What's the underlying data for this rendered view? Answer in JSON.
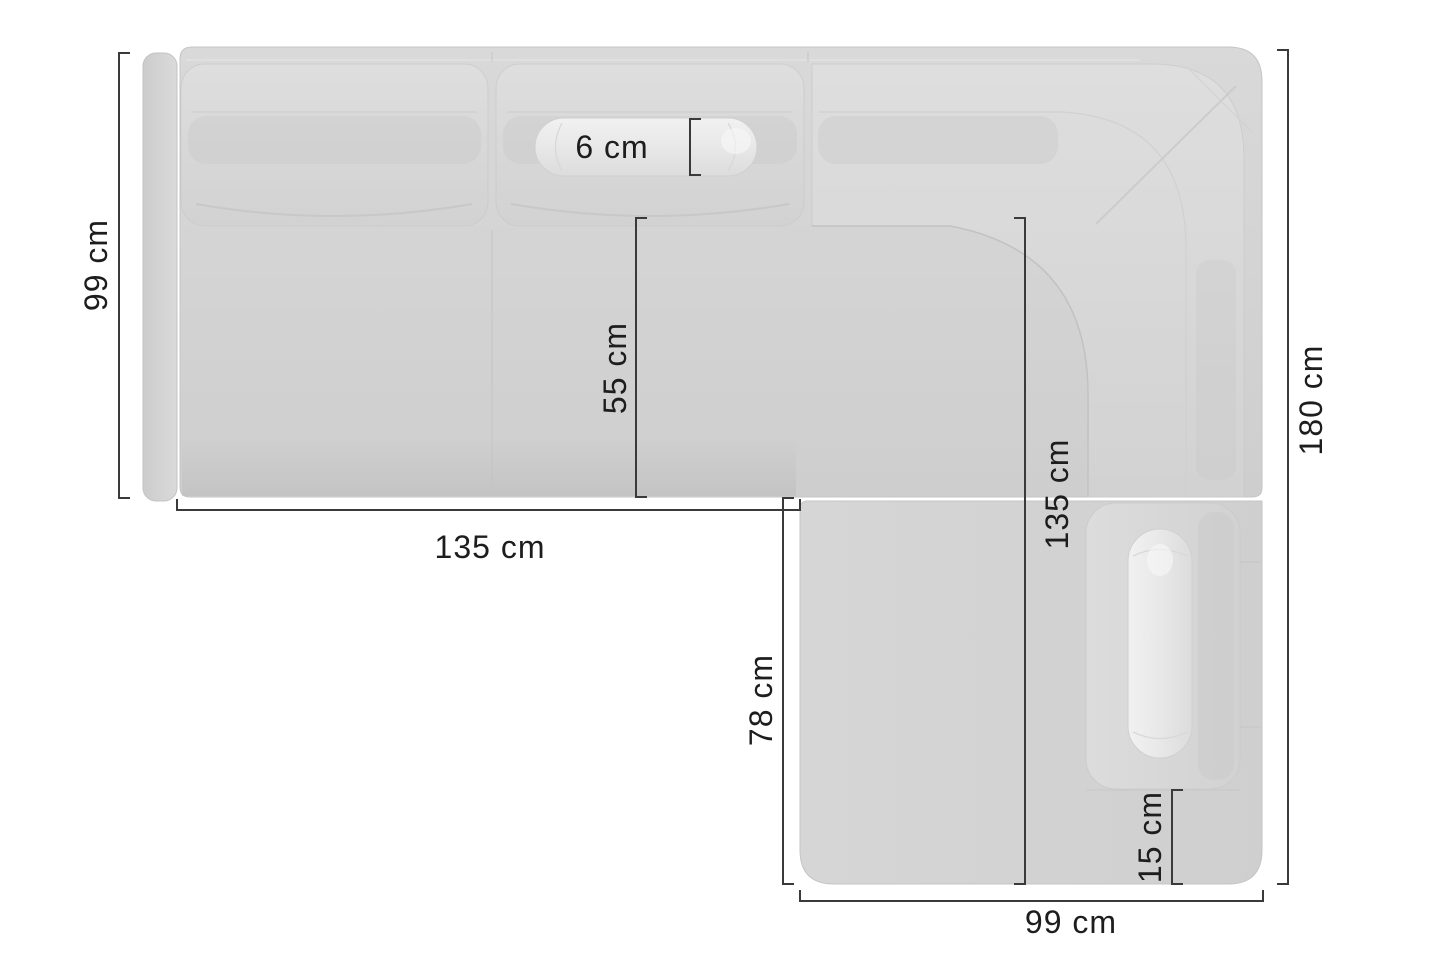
{
  "diagram": {
    "description": "Top-down dimension drawing of a corner sofa with right chaise",
    "background_color": "#ffffff",
    "dimension_line_color": "#3a3a3a",
    "label_text_color": "#1d1d1d",
    "sofa_body_color": "#d4d4d4",
    "cushion_color": "#d9d9d9",
    "pillow_color": "#ececec",
    "measurements": {
      "backrest_depth_left": {
        "text": "99 cm"
      },
      "bolster_pillow": {
        "text": "6 cm"
      },
      "seat_depth": {
        "text": "55 cm"
      },
      "left_section_width": {
        "text": "135 cm"
      },
      "inner_depth_right": {
        "text": "135 cm"
      },
      "chaise_inner_length": {
        "text": "78 cm"
      },
      "chaise_front_rail": {
        "text": "15 cm"
      },
      "chaise_width": {
        "text": "99 cm"
      },
      "total_depth_right": {
        "text": "180 cm"
      }
    }
  }
}
